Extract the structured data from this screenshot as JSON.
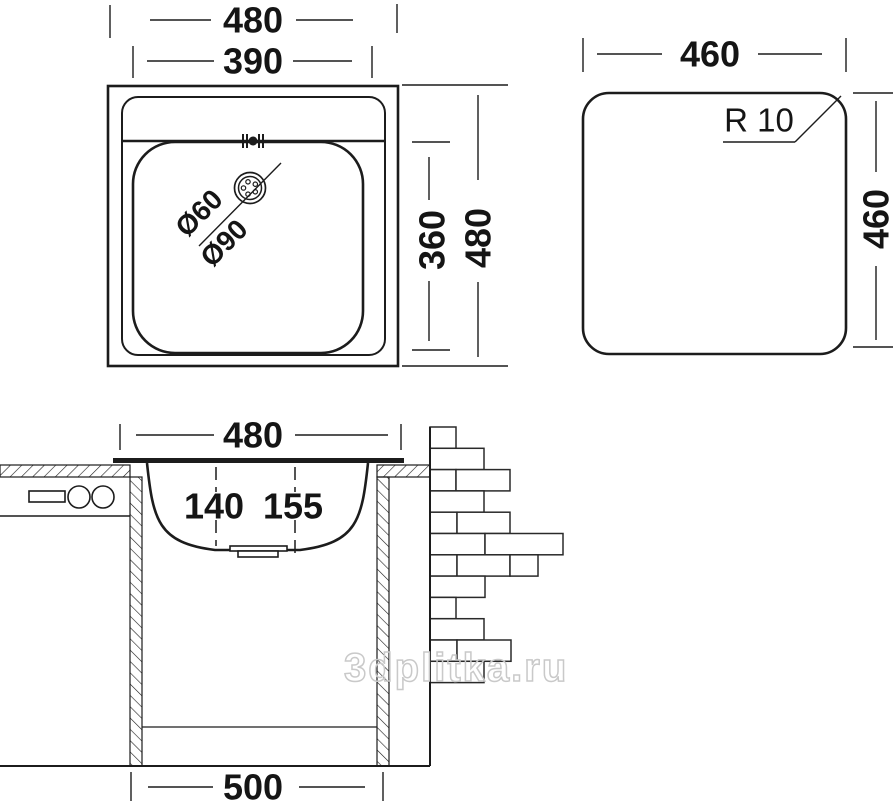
{
  "watermark": {
    "text": "3dplitka.ru",
    "color": "#c9c9c9"
  },
  "colors": {
    "line": "#1c1c1c",
    "background": "#ffffff"
  },
  "plan_view": {
    "dim_outer_width": "480",
    "dim_bowl_width": "390",
    "dim_bowl_height": "360",
    "dim_outer_height": "480",
    "drain_small_diameter": "Ø60",
    "drain_large_diameter": "Ø90"
  },
  "cutout_view": {
    "dim_width": "460",
    "dim_height": "460",
    "corner_radius_label": "R 10"
  },
  "section_view": {
    "dim_top_width": "480",
    "dim_depth_front": "140",
    "dim_depth_back": "155",
    "dim_cabinet_width": "500",
    "bricks": {
      "x": 430,
      "y": 427,
      "row_height": 21.3,
      "rows": [
        [
          26
        ],
        [
          54
        ],
        [
          26,
          54
        ],
        [
          54
        ],
        [
          27,
          53
        ],
        [
          55,
          78
        ],
        [
          27,
          53,
          28
        ],
        [
          55
        ],
        [
          26
        ],
        [
          54
        ],
        [
          27,
          54
        ],
        [
          54
        ]
      ]
    }
  }
}
